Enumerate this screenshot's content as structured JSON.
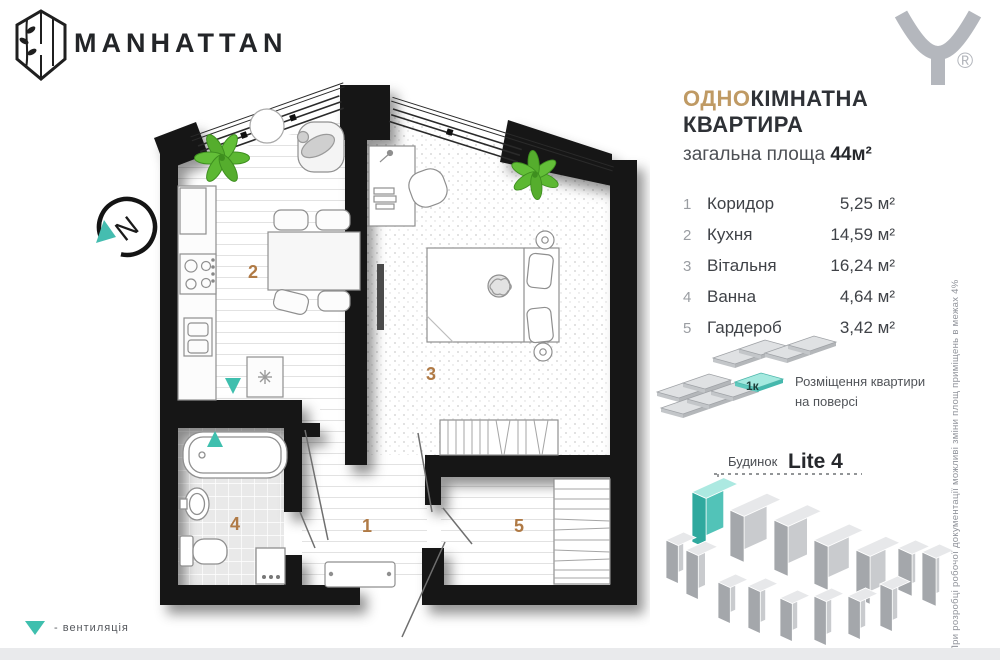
{
  "brand": {
    "name": "MANHATTAN",
    "mark_registered": "®"
  },
  "compass": {
    "label": "N"
  },
  "title": {
    "accent": "ОДНО",
    "rest": "КІМНАТНА КВАРТИРА",
    "subtitle_label": "загальна площа",
    "area_value": "44м²"
  },
  "rooms": [
    {
      "num": "1",
      "name": "Коридор",
      "area": "5,25 м²"
    },
    {
      "num": "2",
      "name": "Кухня",
      "area": "14,59 м²"
    },
    {
      "num": "3",
      "name": "Вітальня",
      "area": "16,24 м²"
    },
    {
      "num": "4",
      "name": "Ванна",
      "area": "4,64 м²"
    },
    {
      "num": "5",
      "name": "Гардероб",
      "area": "3,42 м²"
    }
  ],
  "placement": {
    "badge": "1к",
    "caption1": "Розміщення квартири",
    "caption2": "на поверсі"
  },
  "building": {
    "label_regular": "Будинок",
    "label_bold": "Lite 4"
  },
  "plan": {
    "labels": {
      "r1": "1",
      "r2": "2",
      "r3": "3",
      "r4": "4",
      "r5": "5"
    }
  },
  "legend": {
    "vent_label": "- вентиляція"
  },
  "disclaimer": {
    "text": "При розробці робочої документації можливі зміни площ приміщень в межах 4%"
  },
  "colors": {
    "accent_gold": "#bf9a64",
    "teal": "#3fbfae",
    "room_number": "#b07a45",
    "wall_black": "#161616",
    "building_gray": "#c9cbce",
    "logo_gray": "#b4b7bd"
  }
}
